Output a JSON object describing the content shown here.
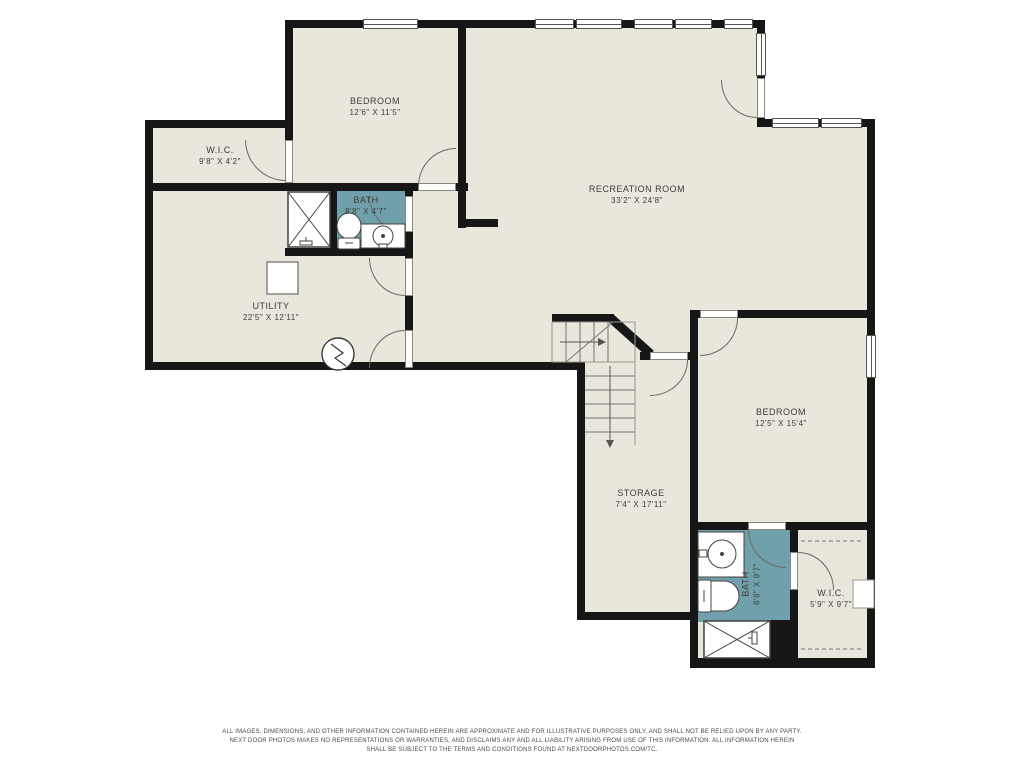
{
  "document": {
    "type": "residential-floor-plan",
    "level": "basement"
  },
  "palette": {
    "floor_fill": "#e9e7dc",
    "wall": "#161616",
    "bath_fill": "#6fa0ac",
    "thin_line": "#55544e",
    "label_text": "#3e3c36",
    "background": "#ffffff"
  },
  "rooms": {
    "bedroom1": {
      "name": "BEDROOM",
      "dims": "12'6\" X 11'5\""
    },
    "wic1": {
      "name": "W.I.C.",
      "dims": "9'8\" X 4'2\""
    },
    "bath1": {
      "name": "BATH",
      "dims": "8'8\" X 4'7\""
    },
    "utility": {
      "name": "UTILITY",
      "dims": "22'5\" X 12'11\""
    },
    "recreation": {
      "name": "RECREATION ROOM",
      "dims": "33'2\" X 24'8\""
    },
    "bedroom2": {
      "name": "BEDROOM",
      "dims": "12'5\" X 15'4\""
    },
    "storage": {
      "name": "STORAGE",
      "dims": "7'4\" X 17'11\""
    },
    "bath2": {
      "name": "BATH",
      "dims": "6'8\" X 9'7\""
    },
    "wic2": {
      "name": "W.I.C.",
      "dims": "5'9\" X 9'7\""
    }
  },
  "icons": {
    "shower": "box-with-x-pattern",
    "toilet": "toilet-icon",
    "sink": "round-basin-icon",
    "water_heater": "square-appliance-icon",
    "electrical": "circle-with-zigzag-icon",
    "stairs": "treads-with-direction-arrows",
    "closet_rod": "dashed-line",
    "window": "white-bar-with-center-line",
    "door": "quarter-circle-swing-arc"
  },
  "footer": {
    "line1": "ALL IMAGES, DIMENSIONS, AND OTHER INFORMATION CONTAINED HEREIN ARE APPROXIMATE AND FOR ILLUSTRATIVE PURPOSES ONLY, AND SHALL NOT BE RELIED UPON BY ANY PARTY.",
    "line2": "NEXT DOOR PHOTOS MAKES NO REPRESENTATIONS OR WARRANTIES, AND DISCLAIMS ANY AND ALL LIABILITY ARISING FROM USE OF THIS INFORMATION. ALL INFORMATION HEREIN",
    "line3": "SHALL BE SUBJECT TO THE TERMS AND CONDITIONS FOUND AT NEXTDOORPHOTOS.COM/TC."
  }
}
